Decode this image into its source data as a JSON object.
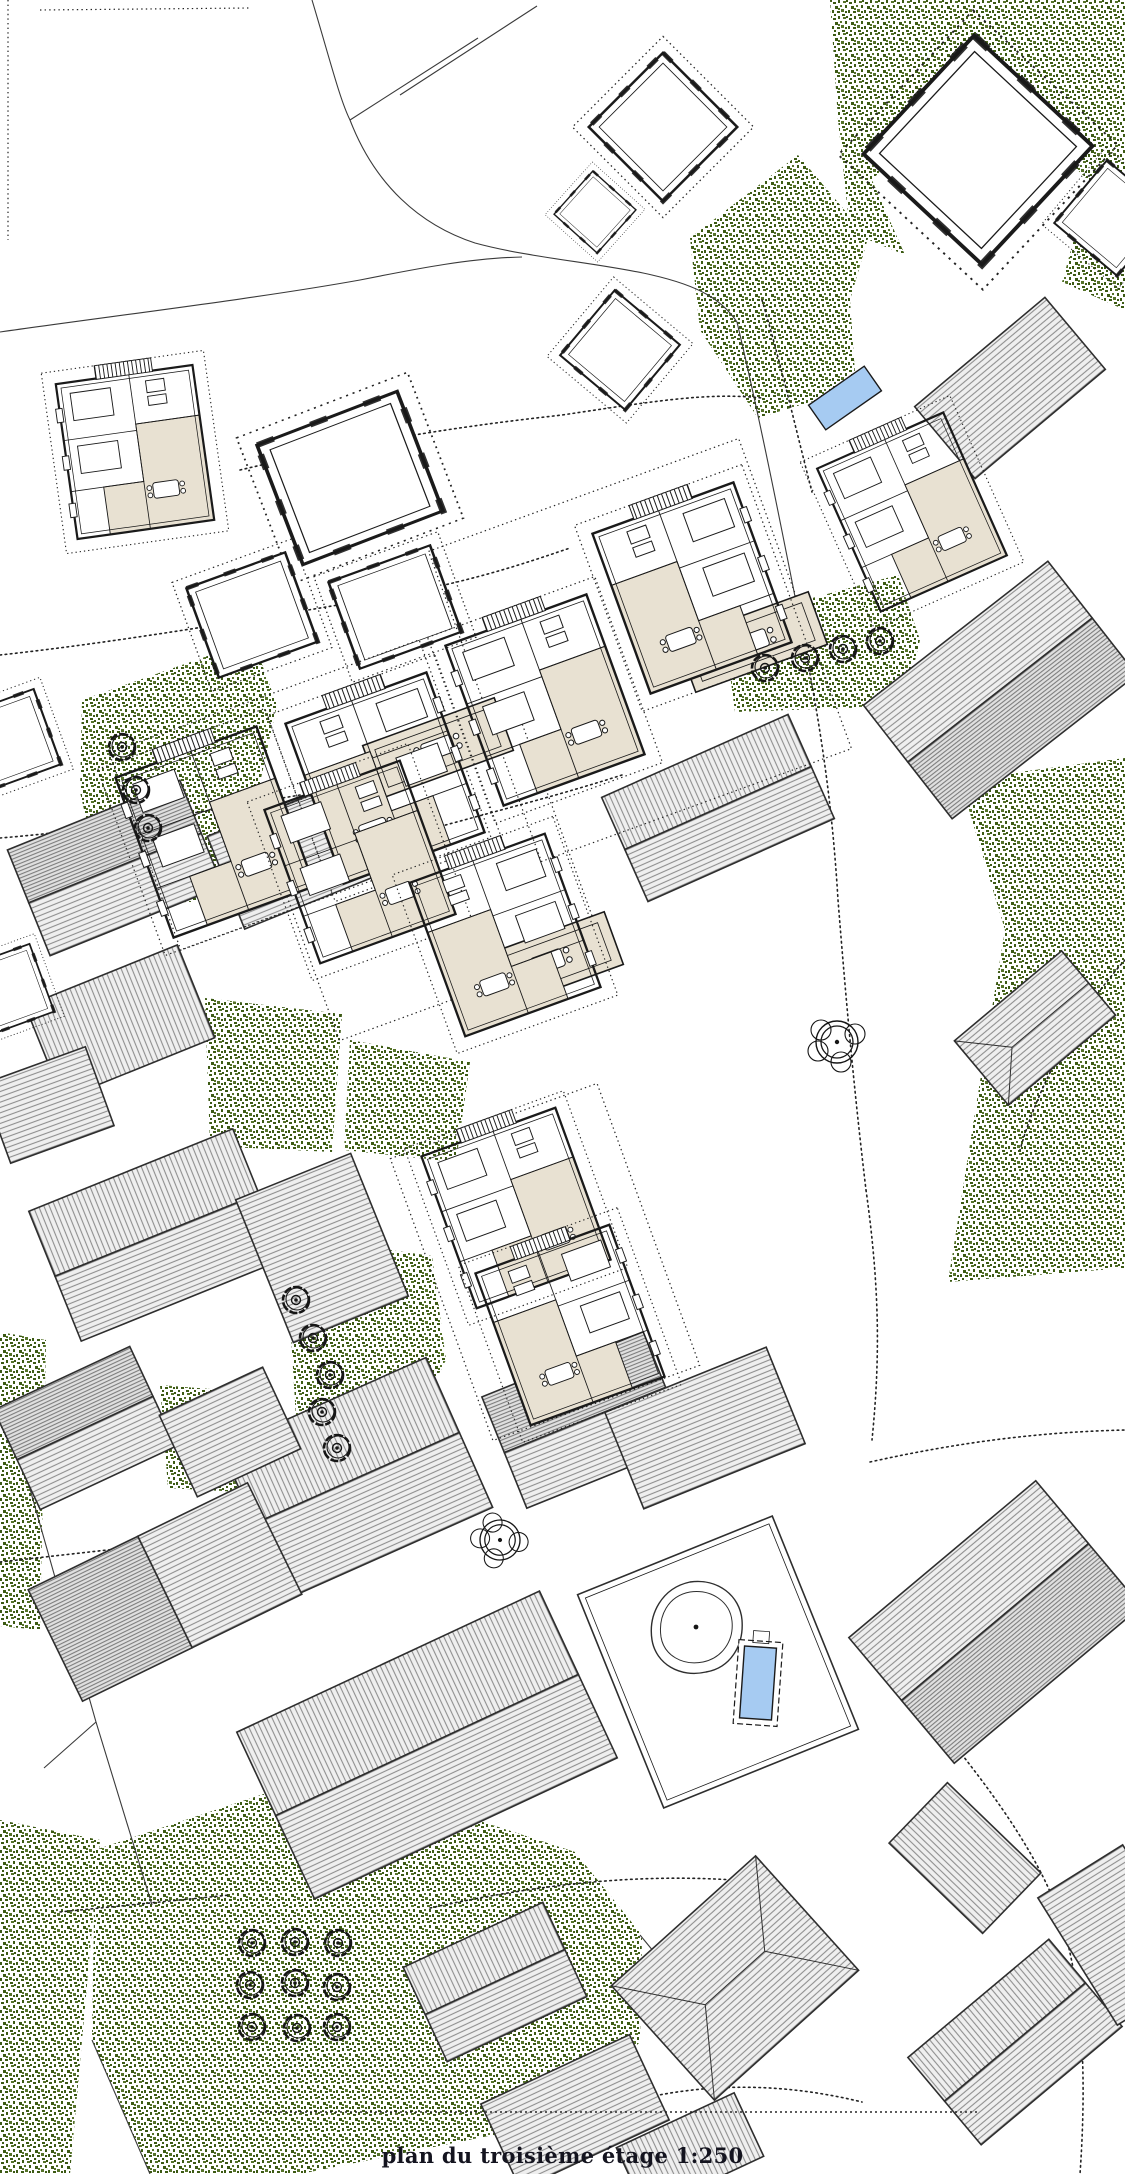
{
  "document": {
    "type": "architectural site plan",
    "caption": "plan du troisième étage 1:250",
    "floor_label": "plan du troisième étage",
    "scale": "1:250"
  },
  "colors": {
    "ink": "#1a1a1a",
    "paper": "#ffffff",
    "veg1": "#3c5a14",
    "veg2": "#557229",
    "beige": "#e8e1d2",
    "roof_fill": "#efefef",
    "roof_fill_dark": "#e0e0e0",
    "roof_line": "#8f8f8f",
    "blue": "#a6cbf2",
    "dot": "#222222",
    "caption_ink": "#14141f"
  },
  "features": {
    "apartment_units_with_beige_interior": 10,
    "garden_tree_count": 21,
    "rosette_tree_count": 2,
    "fountain_blob_count": 1,
    "pool_count": 2,
    "vegetation_patches": 12,
    "hatched_roof_buildings": 24,
    "outline_only_buildings": 10
  }
}
